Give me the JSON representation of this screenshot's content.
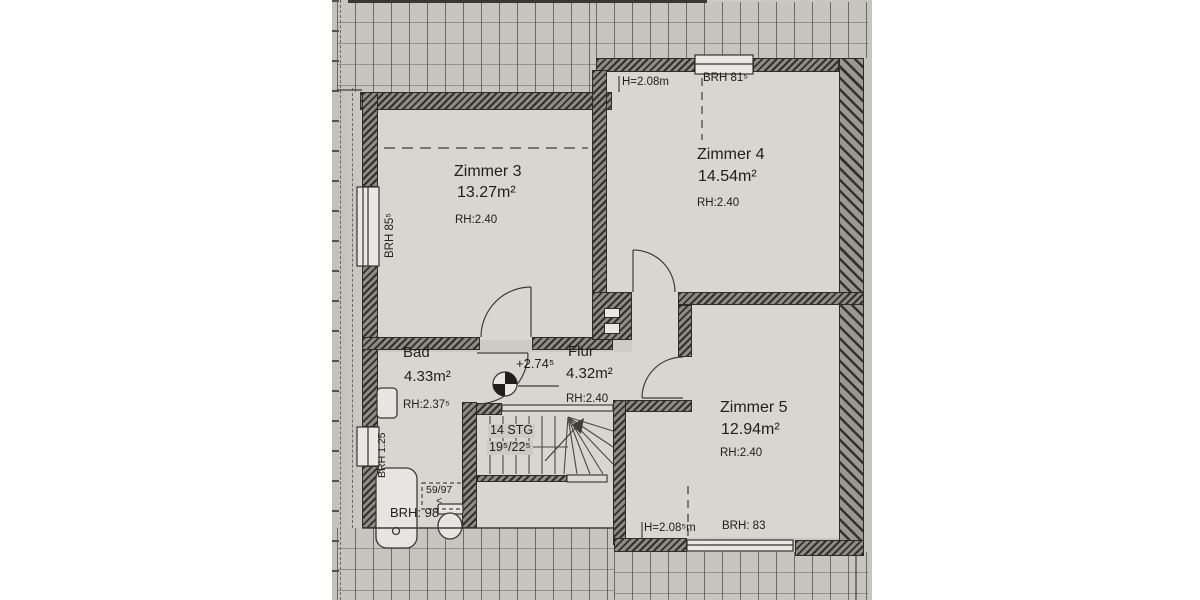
{
  "plan": {
    "rooms": {
      "zimmer3": {
        "name": "Zimmer 3",
        "area": "13.27m²",
        "room_height": "RH:2.40",
        "window_sill": "BRH 85⁵"
      },
      "zimmer4": {
        "name": "Zimmer 4",
        "area": "14.54m²",
        "room_height": "RH:2.40",
        "clear_height": "H=2.08m",
        "window_sill": "BRH 81⁵"
      },
      "zimmer5": {
        "name": "Zimmer 5",
        "area": "12.94m²",
        "room_height": "RH:2.40",
        "clear_height": "H=2.08⁵m",
        "window_sill": "BRH: 83"
      },
      "bad": {
        "name": "Bad",
        "area": "4.33m²",
        "room_height": "RH:2.37⁵",
        "window_sill": "BRH 1.25",
        "tub_sill": "BRH: 98",
        "fixture_dim": "59/97",
        "fixture_mark": "<"
      },
      "flur": {
        "name": "Flur",
        "area": "4.32m²",
        "room_height": "RH:2.40"
      }
    },
    "stairs": {
      "steps": "14 STG",
      "rise_run": "19⁵/22⁵"
    },
    "level_mark": "+2.74⁵"
  },
  "colors": {
    "paper": "#cdc9c3",
    "room_fill": "#d9d6d0",
    "wall": "#312f2c",
    "text": "#21201e"
  }
}
